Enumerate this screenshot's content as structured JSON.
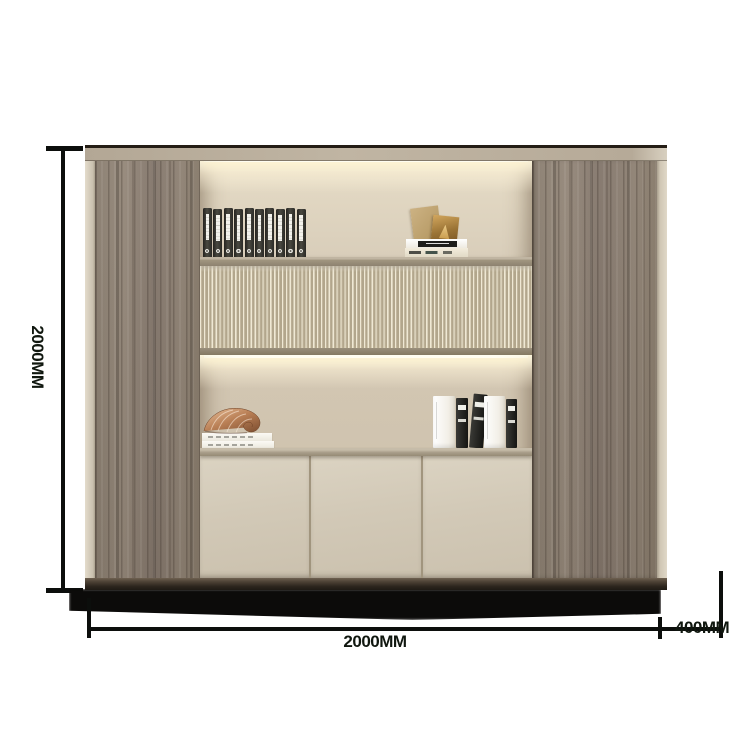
{
  "page": {
    "background": "#ffffff"
  },
  "dimensions": {
    "height": {
      "label": "2000MM"
    },
    "width": {
      "label": "2000MM"
    },
    "depth": {
      "label": "400MM"
    },
    "line_color": "#0c0e0c"
  },
  "cabinet": {
    "palette": {
      "wood": "#877b6d",
      "niche_bg": "#d3c8b4",
      "fluted_slat": "#b2a68c",
      "fluted_gap": "#efe8d4",
      "shelf": "#9d9281",
      "counter": "#a99e8a",
      "door": "#d2c9b7",
      "door_seam": "#a1957e",
      "side_edge": "#d9d1c1",
      "plinth": "#2c251d",
      "led_glow": "#fdf3d9"
    },
    "doors_count": 3,
    "decor": {
      "binders": {
        "count": 10,
        "body": "#2b2a26",
        "label": "#f3f2ec"
      },
      "upper_art": {
        "card_color": "#c3a878",
        "plate_color": "#b8893f"
      },
      "upper_books": [
        {
          "spine": "#ffffff",
          "band": "#1e1e1c"
        },
        {
          "spine": "#ece4d0",
          "band": "#44534b"
        }
      ],
      "shell": {
        "color": "#b97f55"
      },
      "left_book_stack": {
        "count": 2,
        "color": "#f6f3ec"
      },
      "right_books": [
        {
          "w": 22,
          "h": 52,
          "style": "white",
          "tilt": 0
        },
        {
          "w": 12,
          "h": 50,
          "style": "black",
          "tilt": 0
        },
        {
          "w": 14,
          "h": 54,
          "style": "black",
          "tilt": 5
        },
        {
          "w": 21,
          "h": 52,
          "style": "white",
          "tilt": 0
        },
        {
          "w": 11,
          "h": 49,
          "style": "black",
          "tilt": 0
        }
      ]
    }
  }
}
